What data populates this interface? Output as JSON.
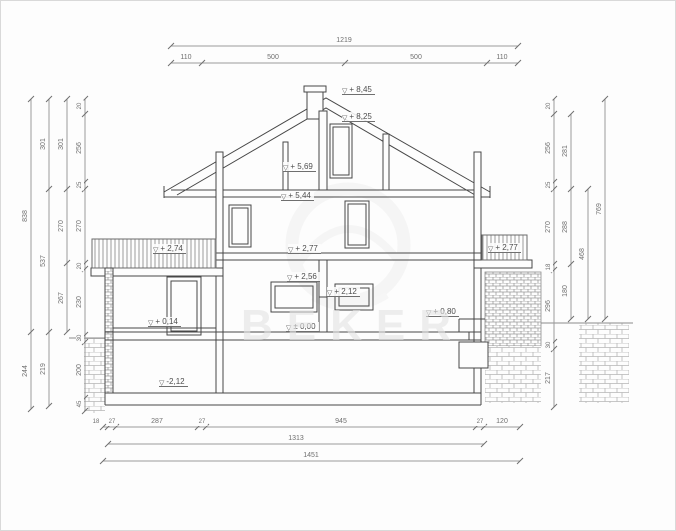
{
  "watermark": {
    "text": "BEKER"
  },
  "colors": {
    "drawing_line": "#474747",
    "dimension_line": "#9a9a9a",
    "tick": "#6f6f6f",
    "dimension_text": "#6f6f6f",
    "elevation_text": "#4e4e4e",
    "hatch": "#b5b5b5",
    "watermark": "#e4e4e4"
  },
  "dims_horizontal": [
    {
      "y": 45,
      "x1": 170,
      "x2": 517,
      "ticks": [
        170,
        517
      ],
      "labels": [
        {
          "t": "1219",
          "x": 343
        }
      ]
    },
    {
      "y": 62,
      "x1": 170,
      "x2": 517,
      "ticks": [
        170,
        201,
        344,
        486,
        517
      ],
      "labels": [
        {
          "t": "110",
          "x": 185
        },
        {
          "t": "500",
          "x": 272
        },
        {
          "t": "500",
          "x": 415
        },
        {
          "t": "110",
          "x": 501
        }
      ]
    },
    {
      "y": 426,
      "x1": 102,
      "x2": 519,
      "ticks": [
        102,
        107,
        115,
        197,
        205,
        475,
        483,
        519
      ],
      "labels": [
        {
          "t": "18",
          "x": 95
        },
        {
          "t": "27",
          "x": 111
        },
        {
          "t": "287",
          "x": 156
        },
        {
          "t": "27",
          "x": 201
        },
        {
          "t": "945",
          "x": 340
        },
        {
          "t": "27",
          "x": 479
        },
        {
          "t": "120",
          "x": 501
        }
      ]
    },
    {
      "y": 443,
      "x1": 107,
      "x2": 483,
      "ticks": [
        107,
        483
      ],
      "labels": [
        {
          "t": "1313",
          "x": 295
        }
      ]
    },
    {
      "y": 460,
      "x1": 102,
      "x2": 519,
      "ticks": [
        102,
        519
      ],
      "labels": [
        {
          "t": "1451",
          "x": 310
        }
      ]
    }
  ],
  "dims_vertical": [
    {
      "x": 30,
      "y1": 98,
      "y2": 408,
      "ticks": [
        98,
        331,
        408
      ],
      "labels": [
        {
          "t": "838",
          "y": 215
        },
        {
          "t": "244",
          "y": 370
        }
      ]
    },
    {
      "x": 48,
      "y1": 98,
      "y2": 405,
      "ticks": [
        98,
        188,
        331,
        405
      ],
      "labels": [
        {
          "t": "301",
          "y": 143
        },
        {
          "t": "537",
          "y": 260
        },
        {
          "t": "219",
          "y": 368
        }
      ]
    },
    {
      "x": 66,
      "y1": 98,
      "y2": 331,
      "ticks": [
        98,
        188,
        262,
        331
      ],
      "labels": [
        {
          "t": "301",
          "y": 143
        },
        {
          "t": "270",
          "y": 225
        },
        {
          "t": "267",
          "y": 297
        }
      ]
    },
    {
      "x": 84,
      "y1": 98,
      "y2": 410,
      "ticks": [
        98,
        113,
        181,
        188,
        262,
        268,
        334,
        341,
        397,
        410
      ],
      "labels": [
        {
          "t": "20",
          "y": 105
        },
        {
          "t": "256",
          "y": 147
        },
        {
          "t": "25",
          "y": 184
        },
        {
          "t": "270",
          "y": 225
        },
        {
          "t": "20",
          "y": 265
        },
        {
          "t": "230",
          "y": 301
        },
        {
          "t": "30",
          "y": 337
        },
        {
          "t": "200",
          "y": 369
        },
        {
          "t": "45",
          "y": 403
        }
      ]
    },
    {
      "x": 553,
      "y1": 98,
      "y2": 406,
      "ticks": [
        98,
        113,
        181,
        188,
        263,
        269,
        341,
        348,
        406
      ],
      "labels": [
        {
          "t": "20",
          "y": 105
        },
        {
          "t": "256",
          "y": 147
        },
        {
          "t": "25",
          "y": 184
        },
        {
          "t": "270",
          "y": 226
        },
        {
          "t": "18",
          "y": 266
        },
        {
          "t": "296",
          "y": 305
        },
        {
          "t": "30",
          "y": 344
        },
        {
          "t": "217",
          "y": 377
        }
      ]
    },
    {
      "x": 570,
      "y1": 113,
      "y2": 318,
      "ticks": [
        113,
        188,
        263,
        318
      ],
      "labels": [
        {
          "t": "281",
          "y": 150
        },
        {
          "t": "288",
          "y": 226
        },
        {
          "t": "180",
          "y": 290
        }
      ]
    },
    {
      "x": 587,
      "y1": 188,
      "y2": 318,
      "ticks": [
        188,
        318
      ],
      "labels": [
        {
          "t": "468",
          "y": 253
        }
      ]
    },
    {
      "x": 604,
      "y1": 98,
      "y2": 318,
      "ticks": [
        98,
        318
      ],
      "labels": [
        {
          "t": "769",
          "y": 208
        }
      ]
    }
  ],
  "elevations": [
    {
      "t": "+ 8,45",
      "x": 341,
      "y": 84
    },
    {
      "t": "+ 8,25",
      "x": 341,
      "y": 111
    },
    {
      "t": "+ 5,69",
      "x": 282,
      "y": 161
    },
    {
      "t": "+ 5,44",
      "x": 280,
      "y": 190
    },
    {
      "t": "+ 2,77",
      "x": 287,
      "y": 243
    },
    {
      "t": "+ 2,56",
      "x": 286,
      "y": 271
    },
    {
      "t": "+ 2,12",
      "x": 326,
      "y": 286
    },
    {
      "t": "± 0,00",
      "x": 285,
      "y": 321
    },
    {
      "t": "+ 0,14",
      "x": 147,
      "y": 316
    },
    {
      "t": "-2,12",
      "x": 158,
      "y": 376
    },
    {
      "t": "+ 2,74",
      "x": 152,
      "y": 243
    },
    {
      "t": "+ 2,77",
      "x": 487,
      "y": 242
    },
    {
      "t": "+ 0,80",
      "x": 425,
      "y": 306
    }
  ]
}
